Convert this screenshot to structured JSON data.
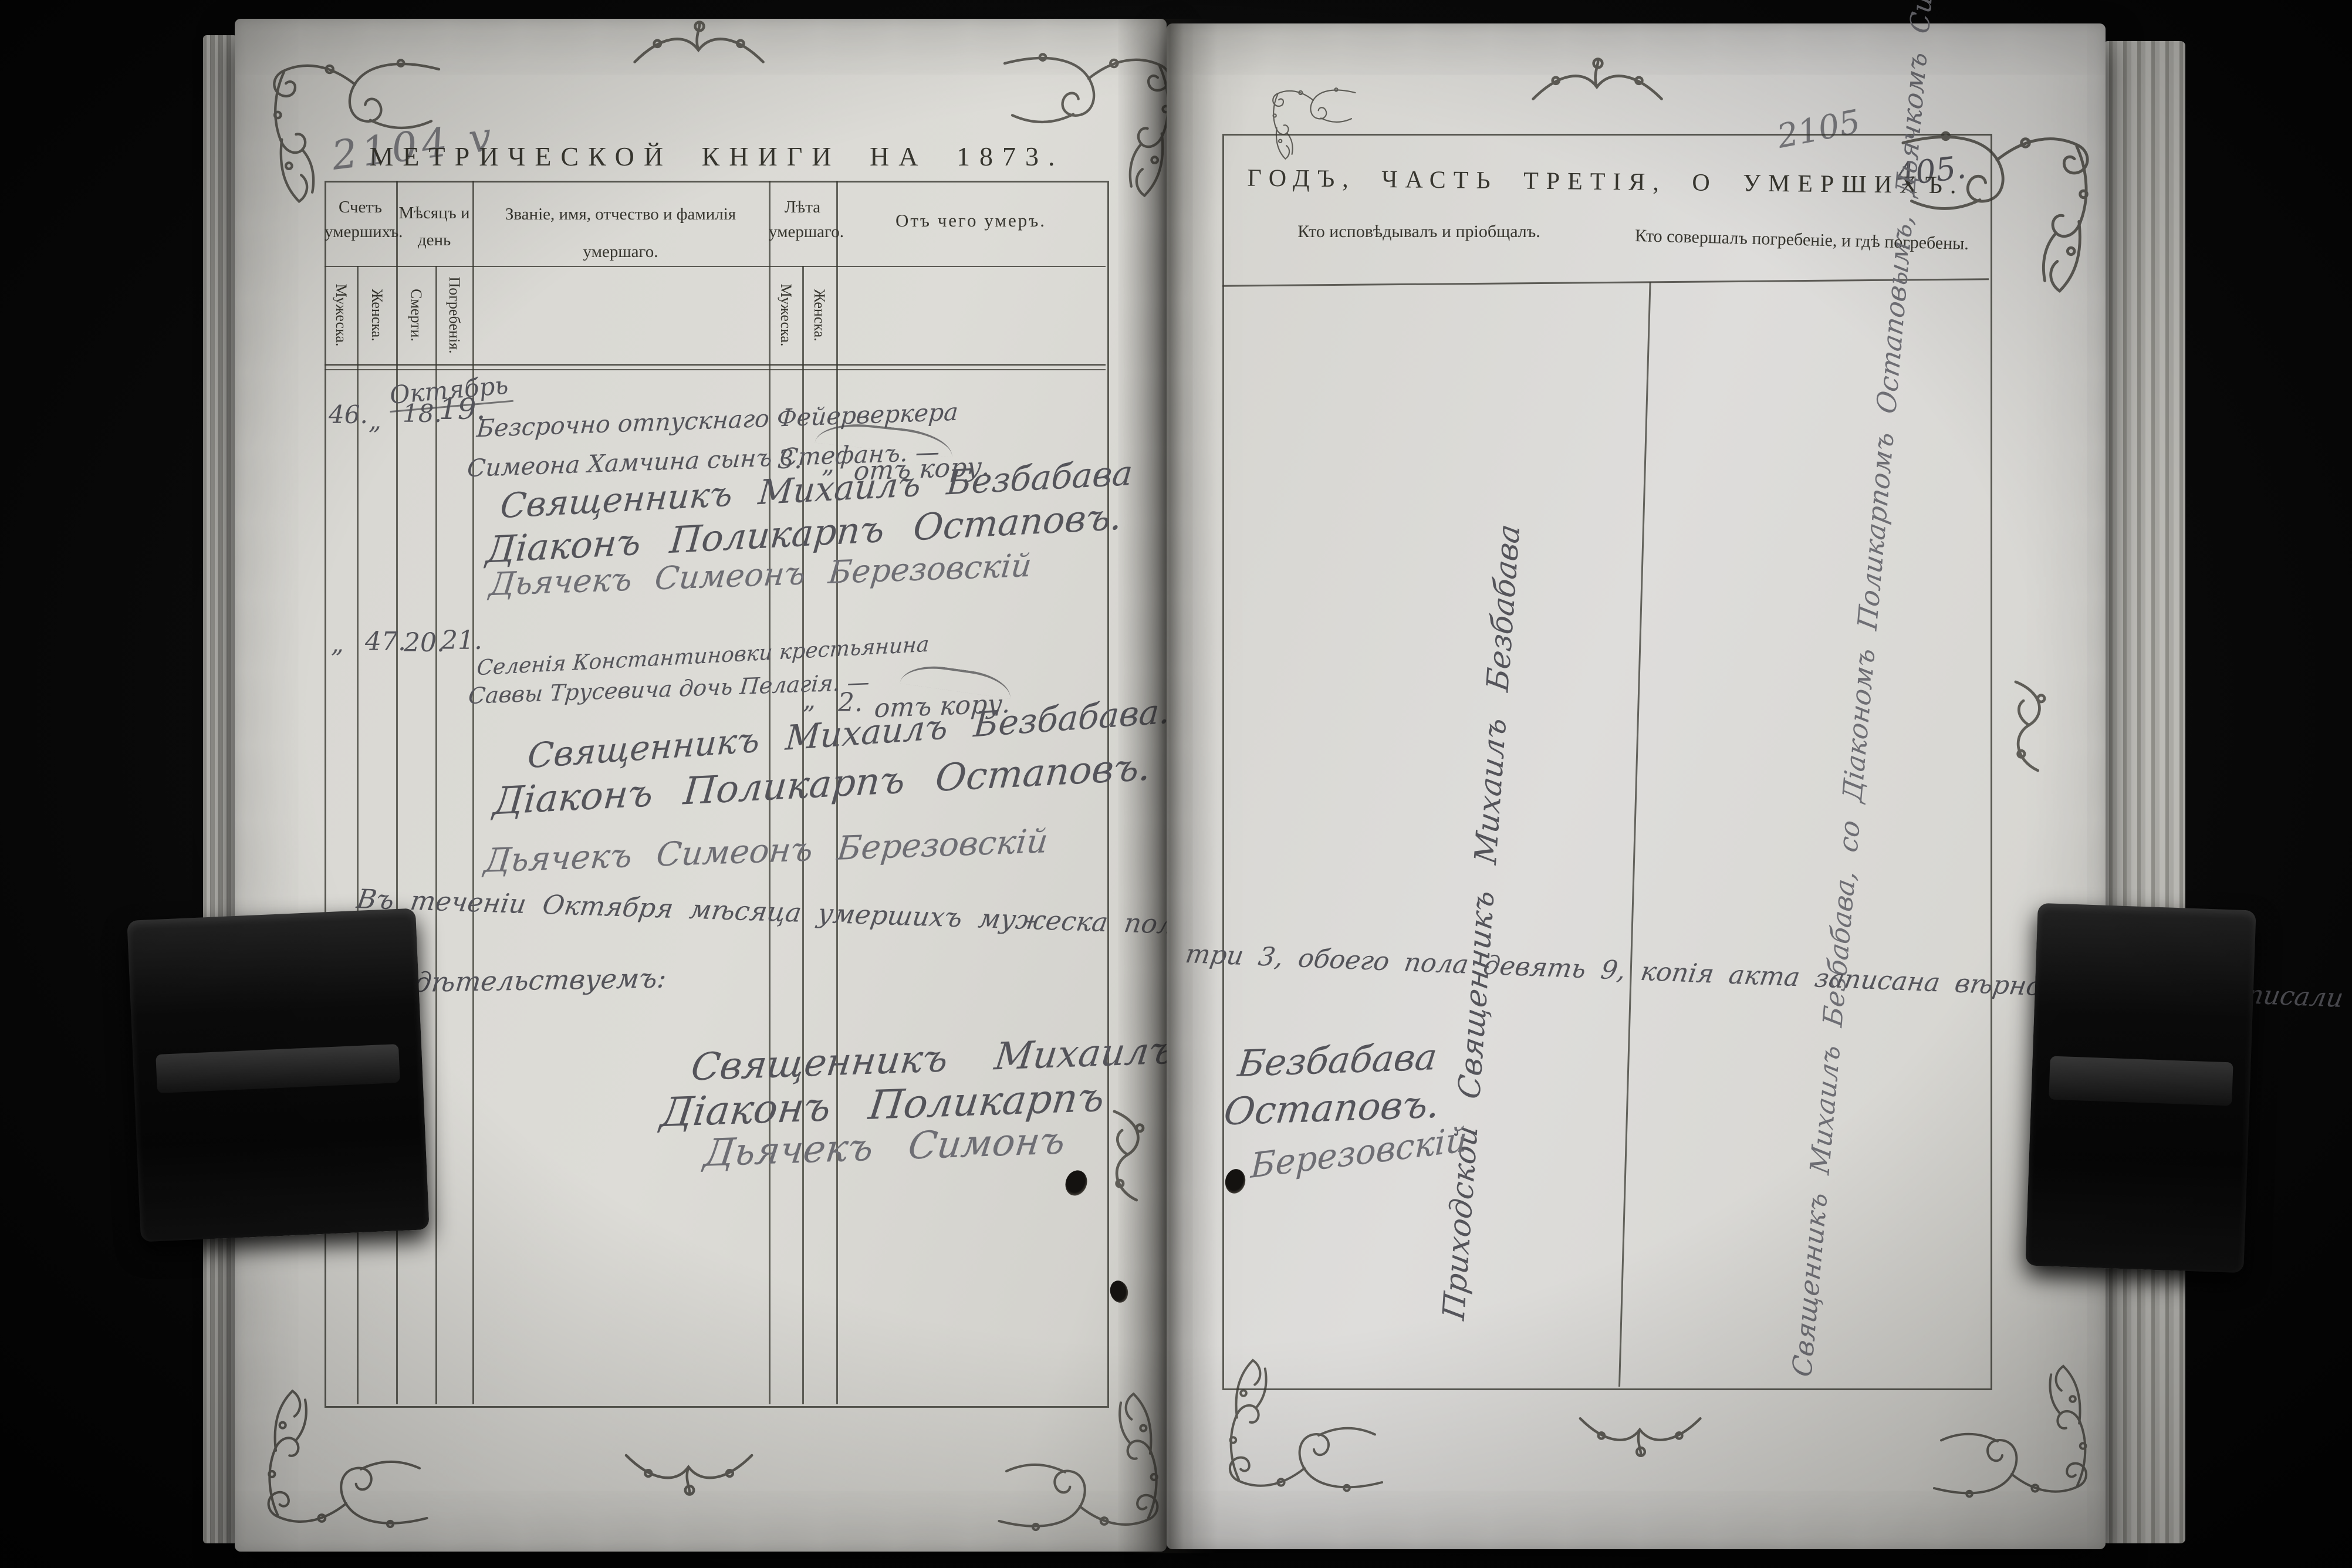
{
  "left_page": {
    "pencil_number": "2104 v",
    "title": "МЕТРИЧЕСКОЙ КНИГИ НА 1873.",
    "columns": {
      "count": "Счетъ умершихъ.",
      "count_male": "Мужеска.",
      "count_female": "Женска.",
      "month": "Мѣсяцъ и день",
      "death": "Смерти.",
      "burial": "Погребенія.",
      "name": "Званіе, имя, отчество и фамилія умершаго.",
      "age": "Лѣта умершаго.",
      "age_male": "Мужеска.",
      "age_female": "Женска.",
      "cause": "Отъ чего умеръ."
    },
    "month_label": "Октябрь",
    "entries": [
      {
        "count_male": "46.",
        "count_female": "„",
        "death_day": "18.",
        "burial_day": "19.",
        "name_line1": "Безсрочно отпускнаго Фейерверкера",
        "name_line2": "Симеона Хамчина сынъ Стефанъ. —",
        "age_male": "3.",
        "age_female": "„",
        "cause": "отъ кору.",
        "sig_priest": "Священникъ Михаилъ Безбабава",
        "sig_deacon": "Діаконъ Поликарпъ Остаповъ.",
        "sig_sexton": "Дьячекъ Симеонъ Березовскій"
      },
      {
        "count_male": "„",
        "count_female": "47.",
        "death_day": "20.",
        "burial_day": "21.",
        "name_line1": "Селенія Константиновки крестьянина",
        "name_line2": "Саввы Трусевича дочь Пелагія. —",
        "age_male": "„",
        "age_female": "2.",
        "cause": "отъ кору.",
        "sig_priest": "Священникъ Михаилъ Безбабава.",
        "sig_deacon": "Діаконъ Поликарпъ Остаповъ.",
        "sig_sexton": "Дьячекъ Симеонъ Березовскій"
      }
    ],
    "certification_line1": "Въ теченіи Октября мѣсяца умершихъ мужеска пола шесть 6, женска пола",
    "certification_line2": "свидѣтельствуемъ:",
    "closing": {
      "priest_left": "Священникъ Михаилъ",
      "deacon_left": "Діаконъ Поликарпъ",
      "sexton_left": "Дьячекъ Симонъ"
    }
  },
  "right_page": {
    "pencil_number": "2105",
    "ink_number": "405.",
    "title": "ГОДЪ, ЧАСТЬ ТРЕТІЯ, О УМЕРШИХЪ.",
    "columns": {
      "confessor": "Кто исповѣдывалъ и пріобщалъ.",
      "burial": "Кто совершалъ погребеніе, и гдѣ погребены."
    },
    "vertical_confessor": "Приходской Священникъ Михаилъ Безбабава",
    "vertical_burial": "Священникъ Михаилъ Безбабава, со Діакономъ Поликарпомъ Остаповымъ, Дьячкомъ Симеономъ Березовскимъ. —",
    "certification_continuation": "три 3, обоего пола девять 9, копія акта записана вѣрно; въ чемъ подписали",
    "closing": {
      "priest_right": "Безбабава",
      "deacon_right": "Остаповъ.",
      "sexton_right": "Березовскій"
    }
  }
}
